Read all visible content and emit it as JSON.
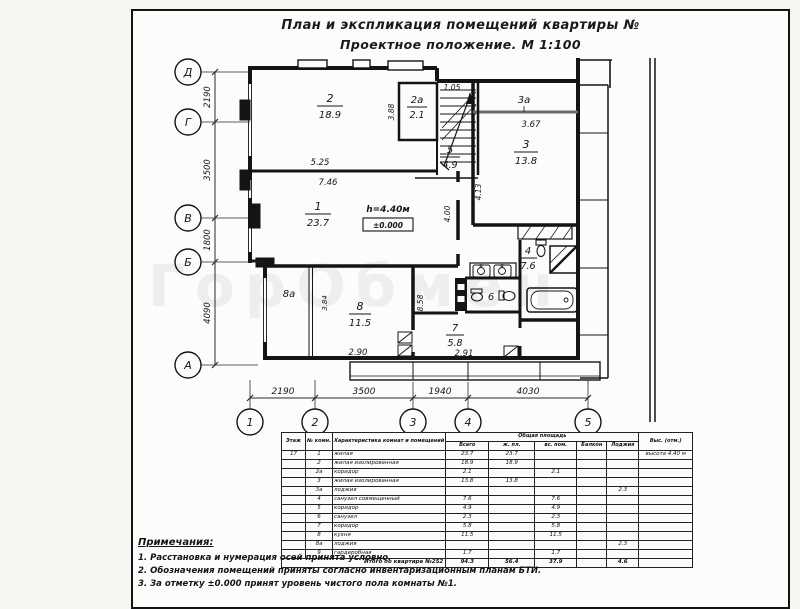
{
  "colors": {
    "ink": "#141414",
    "paper": "#fcfcfa",
    "watermark": "rgba(120,120,120,0.10)"
  },
  "title": {
    "line1": "План и экспликация помещений квартиры №",
    "line2": "Проектное положение. М 1:100"
  },
  "watermark": "ГорОбмен",
  "plan": {
    "axes": {
      "rows": [
        "Д",
        "Г",
        "В",
        "Б",
        "А"
      ],
      "cols": [
        "1",
        "2",
        "3",
        "4",
        "5"
      ],
      "row_dims": [
        "2190",
        "3500",
        "1800",
        "4090"
      ],
      "col_dims": [
        "2190",
        "3500",
        "1940",
        "4030"
      ]
    },
    "rooms": {
      "r1": {
        "no": "1",
        "area": "23.7"
      },
      "r2": {
        "no": "2",
        "area": "18.9"
      },
      "r2a": {
        "no": "2а",
        "area": "2.1"
      },
      "r3": {
        "no": "3",
        "area": "13.8"
      },
      "r3a": {
        "no": "3а"
      },
      "r4": {
        "no": "4",
        "area": "7.6"
      },
      "r5": {
        "no": "5",
        "area": "4.9"
      },
      "r6": {
        "no": "6"
      },
      "r7": {
        "no": "7",
        "area": "5.8"
      },
      "r8": {
        "no": "8",
        "area": "11.5"
      },
      "r8a": {
        "no": "8а"
      }
    },
    "dims": {
      "w525": "5.25",
      "w746": "7.46",
      "w388": "3.88",
      "w105": "1.05",
      "w367": "3.67",
      "w413": "4.13",
      "w400": "4.00",
      "w858": "8.58",
      "w384": "3.84",
      "w290": "2.90",
      "w291": "2.91"
    },
    "height_note": "h=4.40м",
    "level_mark": "±0.000"
  },
  "table": {
    "headers": {
      "floor": "Этаж",
      "room": "№ комн.",
      "descr": "Характеристика комнат и помещений",
      "area_group": "Общая площадь",
      "sub": [
        "Всего",
        "ж. пл.",
        "вс. пом.",
        "Балкон",
        "Лоджия"
      ],
      "note": "Выс. (отм.)"
    },
    "rows": [
      [
        "17",
        "1",
        "жилая",
        "23.7",
        "23.7",
        "",
        "",
        "",
        "высота 4.40 м"
      ],
      [
        "",
        "2",
        "жилая изолированная",
        "18.9",
        "18.9",
        "",
        "",
        "",
        ""
      ],
      [
        "",
        "2а",
        "коридор",
        "2.1",
        "",
        "2.1",
        "",
        "",
        ""
      ],
      [
        "",
        "3",
        "жилая изолированная",
        "13.8",
        "13.8",
        "",
        "",
        "",
        ""
      ],
      [
        "",
        "3а",
        "лоджия",
        "",
        "",
        "",
        "",
        "2.3",
        ""
      ],
      [
        "",
        "4",
        "санузел совмещенный",
        "7.6",
        "",
        "7.6",
        "",
        "",
        ""
      ],
      [
        "",
        "5",
        "коридор",
        "4.9",
        "",
        "4.9",
        "",
        "",
        ""
      ],
      [
        "",
        "6",
        "санузел",
        "2.3",
        "",
        "2.3",
        "",
        "",
        ""
      ],
      [
        "",
        "7",
        "коридор",
        "5.8",
        "",
        "5.8",
        "",
        "",
        ""
      ],
      [
        "",
        "8",
        "кухня",
        "11.5",
        "",
        "11.5",
        "",
        "",
        ""
      ],
      [
        "",
        "8а",
        "лоджия",
        "",
        "",
        "",
        "",
        "2.3",
        ""
      ],
      [
        "",
        "9",
        "гардеробная",
        "1.7",
        "",
        "1.7",
        "",
        "",
        ""
      ]
    ],
    "total": {
      "label": "Итого по квартире №252",
      "values": [
        "94.3",
        "56.4",
        "37.9",
        "",
        "4.6",
        ""
      ]
    }
  },
  "notes": {
    "heading": "Примечания:",
    "items": [
      "1. Расстановка и нумерация осей принята условно.",
      "2. Обозначения помещений приняты согласно инвентаризационным планам БТИ.",
      "3. За отметку ±0.000 принят уровень чистого пола комнаты №1."
    ]
  }
}
